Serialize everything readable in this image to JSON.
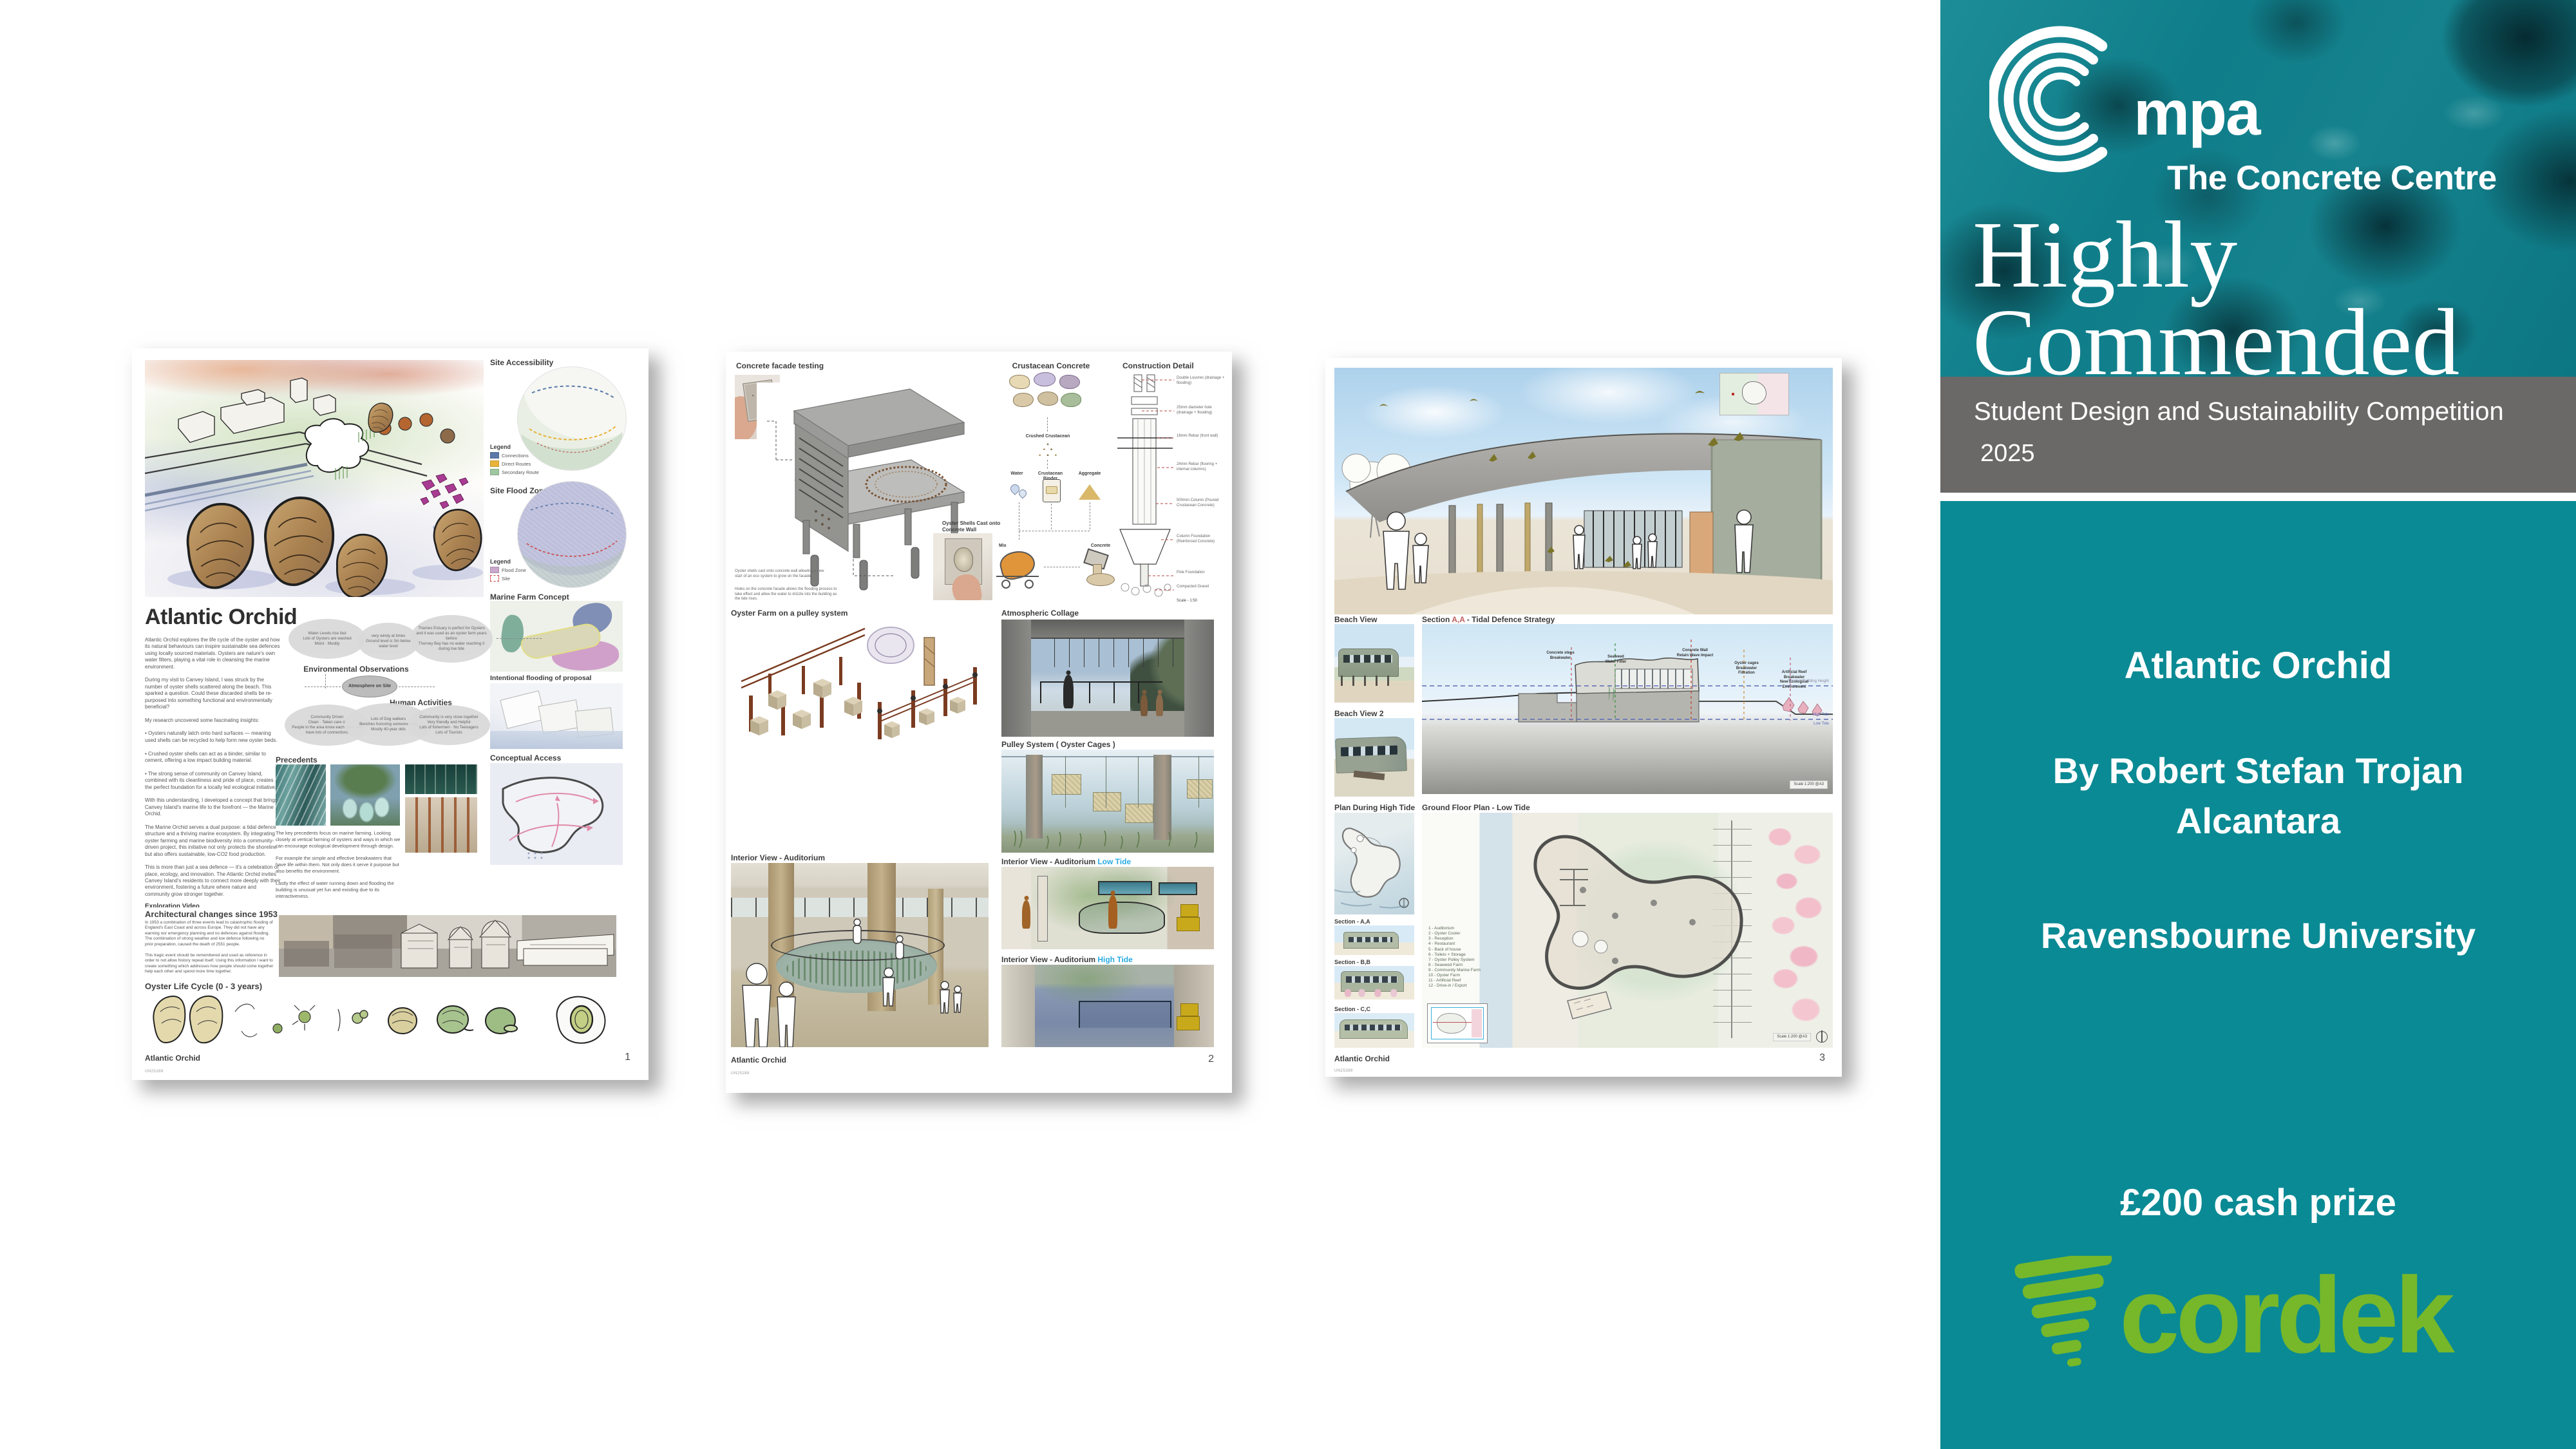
{
  "colors": {
    "teal": "#0a8a94",
    "teal_texture": "#0f7e8a",
    "texture_dark": "#06323a",
    "gray_bar": "#6b6868",
    "cordek_green": "#76b82a",
    "low_tide_accent": "#29abe2",
    "section_ref_red": "#c0605e"
  },
  "sidebar": {
    "logo_acronym": "mpa",
    "logo_subtitle": "The Concrete Centre",
    "award_line1": "Highly",
    "award_line2": "Commended",
    "competition_title": "Student Design and Sustainability Competition",
    "competition_year": "2025",
    "project_title": "Atlantic Orchid",
    "author_line1": "By Robert Stefan Trojan",
    "author_line2": "Alcantara",
    "university": "Ravensbourne University",
    "prize": "£200 cash prize",
    "sponsor_name": "cordek"
  },
  "posters": [
    {
      "page_number": "1",
      "footer_title": "Atlantic Orchid",
      "footer_code": "UN25288",
      "title": "Atlantic Orchid",
      "intro": "Atlantic Orchid explores the life cycle of the oyster and how its natural behaviours can inspire sustainable sea defences using locally sourced materials. Oysters are nature's own water filters, playing a vital role in cleansing the marine environment.\n\nDuring my visit to Canvey Island, I was struck by the number of oyster shells scattered along the beach. This sparked a question. Could these discarded shells be re-purposed into something functional and environmentally beneficial?\n\nMy research uncovered some fascinating insights:\n\n•  Oysters naturally latch onto hard surfaces — meaning used shells can be recycled to help form new oyster beds.\n\n•  Crushed oyster shells can act as a binder, similar to cement, offering a low impact building material.\n\n•  The strong sense of community on Canvey Island, combined with its cleanliness and pride of place, creates the perfect foundation for a locally led ecological initiative.\n\nWith this understanding, I developed a concept that brings Canvey Island's marine life to the forefront — the Marine Orchid.\n\nThe Marine Orchid serves a dual purpose: a tidal defence structure and a thriving marine ecosystem. By integrating oyster farming and marine biodiversity into a community-driven project, this initiative not only protects the shoreline but also offers sustainable, low-CO2 food production.\n\nThis is more than just a sea defence — it's a celebration of place, ecology, and innovation. The Atlantic Orchid invites Canvey Island's residents to connect more deeply with their environment, fostering a future where nature and community grow stronger together.",
      "exploration_title": "Exploration Video",
      "exploration_text": "As I explored the site I made a video to help visualise the key aspects of the area to inform my design decisions.",
      "key_takeaways_title": "Key takeaways",
      "key_takeaways": "- An abundance of crustacean\n- Community driven\n- Marine Sport active\n- Ecological life is thriving",
      "exploration_note": "In the video we see a joyful area which is heavily driven by the community and it's residents.",
      "arch_title": "Architectural changes since 1953",
      "arch_text": "In 1953 a combination of three events lead to catastrophic flooding of England's East Coast and across Europe. They did not have any warning nor emergency planning and no defences against flooding. The combination of strong weather and low defence following no prior preparation, caused the death of 2551 people.\n\nThis tragic event should be remembered and used as reference in order to not allow history repeat itself. Using this information I want to create something which addresses how people should come together help each other and spend more time together.",
      "oyster_cycle_title": "Oyster Life Cycle (0 - 3 years)",
      "site_accessibility_title": "Site Accessibility",
      "legend_title": "Legend",
      "legend1_items": [
        {
          "label": "Connections",
          "color": "#5b79a8"
        },
        {
          "label": "Direct Routes",
          "color": "#e8b33a"
        },
        {
          "label": "Secondary Route",
          "color": "#9fc7a0"
        }
      ],
      "site_flood_title": "Site Flood Zone",
      "legend2_items": [
        {
          "label": "Flood Zone",
          "color": "#c9a8cc"
        },
        {
          "label": "Site",
          "color": "#cc4444"
        }
      ],
      "marine_farm_title": "Marine Farm Concept",
      "intentional_flooding_title": "Intentional flooding of proposal",
      "env_obs_title": "Environmental Observations",
      "atmosphere_label": "Atmosphere on Site",
      "env_bubble1": "Water Levels rise fast\nLots of Oysters are washed\nMoist · Muddy",
      "env_bubble2": "very windy at times\nGround level is 3m below water level",
      "env_bubble3": "Thames Estuary is perfect for Oysters and it was used as an oyster farm years before\nThorney Bay has no water reaching it during low tide",
      "human_activities_title": "Human Activities",
      "venn_bubble1": "Community Driven\nClean · Taken care of\nPeople in the area know each other and have lots of connections",
      "venn_bubble2": "Lots of Dog walkers\nBenches honoring someones life\nMostly 40-year olds",
      "venn_bubble3": "Community is very close together\nVery friendly and Helpful\nLots of fishermen · No Teenagers\nLots of Tourists",
      "precedents_title": "Precedents",
      "precedents_text": "The key precedents focus on marine farming. Looking closely at vertical farming of oysters and ways in which we can encourage ecological development through design.\n\nFor example the simple and effective breakwaters that have life within them. Not only does it serve it purpose but also benefits the environment.\n\nLastly the effect of water running down and flooding the building is unusual yet fun and existing due to its interactiveness.",
      "conceptual_access_title": "Conceptual Access"
    },
    {
      "page_number": "2",
      "footer_title": "Atlantic Orchid",
      "footer_code": "UN25288",
      "facade_title": "Concrete facade testing",
      "facade_note1": "Oyster shells cast onto concrete wall allowing a new start of an eco system to grow on the facade.",
      "facade_note2": "Holes on the concrete facade allows the flooding process to take effect and allow the water to drizzle into the building as the tide rises.",
      "oyster_cast_label": "Oyster Shells Cast onto\nConcrete Wall",
      "crustacean_title": "Crustacean Concrete",
      "crushed_label": "Crushed Crustacean",
      "water_label": "Water",
      "binder_label": "Crustacean Binder",
      "aggregate_label": "Aggregate",
      "mix_label": "Mix",
      "concrete_label": "Concrete",
      "construction_title": "Construction Detail",
      "detail_callouts": [
        "Double Louvres (drainage + flooding)",
        "25mm diameter hole (drainage + flooding)",
        "16mm Rebar (front wall)",
        "24mm Rebar (flooring + internal columns)",
        "500mm Column (Poured Crustacean Concrete)",
        "Column Foundation (Reinforced Concrete)",
        "Pole Foundation",
        "Compacted Gravel"
      ],
      "detail_scale": "Scale - 1:50",
      "oyster_farm_title": "Oyster Farm on a pulley system",
      "collage_title": "Atmospheric Collage",
      "pulley_title": "Pulley System ( Oyster Cages )",
      "interior_title": "Interior View - Auditorium",
      "interior_low_title": "Interior View - Auditorium ",
      "low_tide": "Low Tide",
      "interior_high_title": "Interior View - Auditorium ",
      "high_tide": "High Tide"
    },
    {
      "page_number": "3",
      "footer_title": "Atlantic Orchid",
      "footer_code": "UN25288",
      "beach_view_title": "Beach View",
      "beach_view2_title": "Beach View 2",
      "section_prefix": "Section ",
      "section_ref": "A,A",
      "section_suffix": " - Tidal Defence Strategy",
      "plan_high_title": "Plan During High Tide",
      "ground_plan_title": "Ground Floor Plan - Low Tide",
      "sec_a": "Section - A,A",
      "sec_b": "Section - B,B",
      "sec_c": "Section - C,C",
      "ann_concrete_steps": "Concrete steps\nBreakwater",
      "ann_seaweed": "Seaweed\nWater Filter",
      "ann_wall": "Concrete Wall\nRetain Wave Impact",
      "ann_cages": "Oyster cages\nBreakwater\nFiltration",
      "ann_reef": "Artificial Reef\nBreakwater\nNew Ecological Environment",
      "consent_height": "Consent Building Height",
      "high_tide": "High Tide",
      "low_tide": "Low Tide",
      "scale_label": "Scale  1:200    @A3",
      "plan_legend": "1 - Auditorium\n2 - Oyster Cooler\n3 - Reception\n4 - Restaurant\n5 - Back of house\n6 - Toilets + Storage\n7 - Oyster Pulley System\n8 - Seaweed Farm\n9 - Community Marine Farm\n10 - Oyster Farm\n11 - Artificial Reef\n12 - Drive-in / Export"
    }
  ]
}
